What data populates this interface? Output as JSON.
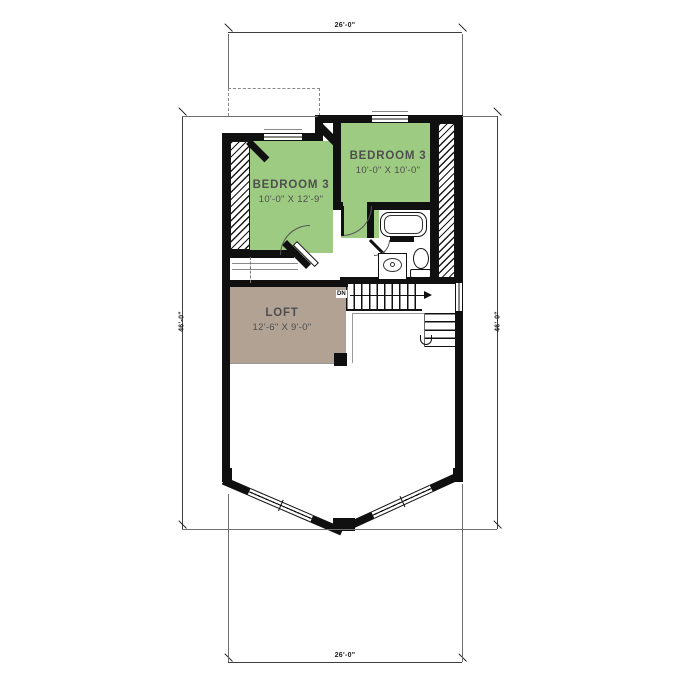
{
  "drawing": {
    "type": "second-floor-plan",
    "dims": {
      "top": "26'-0\"",
      "bottom": "26'-0\"",
      "left": "46'-0\"",
      "right": "46'-0\""
    },
    "rooms": {
      "bedroom_left": {
        "name": "BEDROOM 3",
        "size": "10'-0\" X 12'-9\""
      },
      "bedroom_right": {
        "name": "BEDROOM 3",
        "size": "10'-0\" X 10'-0\""
      },
      "loft": {
        "name": "LOFT",
        "size": "12'-6\" X 9'-0\""
      }
    },
    "stairs": {
      "down_label": "DN"
    },
    "colors": {
      "bedroom_fill": "#9CCB81",
      "loft_fill": "#B1A294",
      "wall": "#101010",
      "dimension_line": "#3f3f3f",
      "text": "#4f4f4f"
    }
  }
}
